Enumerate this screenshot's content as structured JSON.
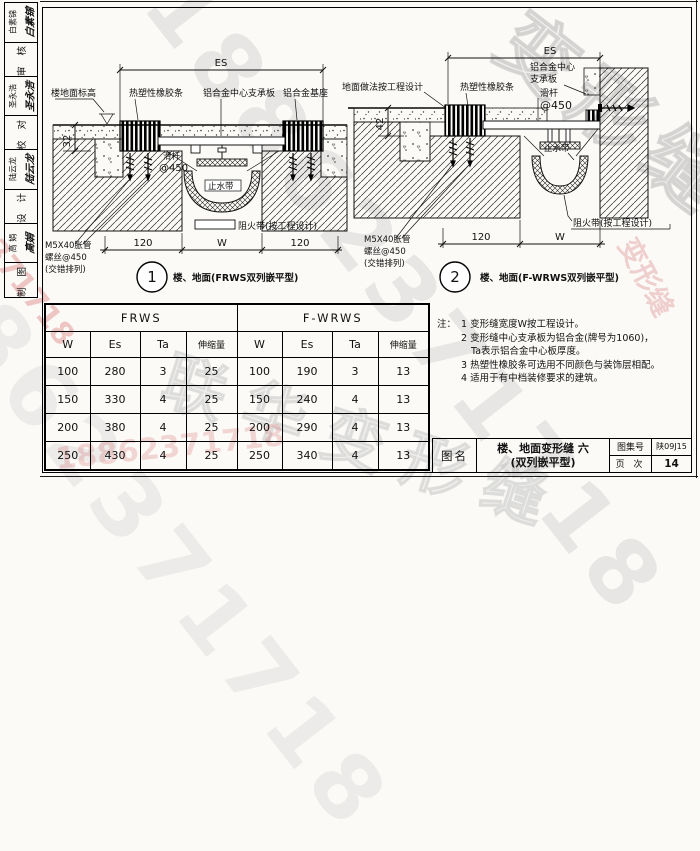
{
  "sidebar": {
    "cells": [
      {
        "name": "白素锦",
        "sig": "白素锦"
      },
      {
        "label": "审 核"
      },
      {
        "name": "圣永浩",
        "sig": "圣永浩"
      },
      {
        "label": "校 对"
      },
      {
        "name": "陆云龙",
        "sig": "陆云龙"
      },
      {
        "label": "设 计"
      },
      {
        "name": "高 娟",
        "sig": "高娟"
      },
      {
        "label": "制 图"
      }
    ]
  },
  "detail1": {
    "es": "ES",
    "dim_thickness": "32",
    "label_floor_level": "楼地面标高",
    "label_rubber": "热塑性橡胶条",
    "label_center_plate": "铝合金中心支承板",
    "label_base": "铝合金基座",
    "label_slide_rod": "滑杆",
    "label_slide_rod_spacing": "@450",
    "label_waterstop": "止水带",
    "label_fire_barrier": "阻火带(按工程设计)",
    "label_anchor_line1": "M5X40胀管",
    "label_anchor_line2": "螺丝@450",
    "label_anchor_line3": "(交错排列)",
    "dim_left": "120",
    "dim_mid": "W",
    "dim_right": "120",
    "bubble": "1",
    "caption": "楼、地面(FRWS双列嵌平型)"
  },
  "detail2": {
    "es": "ES",
    "dim_thickness": "42",
    "label_floor_finish": "地面做法按工程设计",
    "label_rubber": "热塑性橡胶条",
    "label_center_plate_1": "铝合金中心",
    "label_center_plate_2": "支承板",
    "label_slide_rod": "滑杆",
    "label_slide_rod_spacing": "@450",
    "label_waterstop": "止水带",
    "label_fire_barrier": "阻火带(按工程设计)",
    "label_anchor_line1": "M5X40胀管",
    "label_anchor_line2": "螺丝@450",
    "label_anchor_line3": "(交错排列)",
    "dim_left": "120",
    "dim_mid": "W",
    "bubble": "2",
    "caption": "楼、地面(F-WRWS双列嵌平型)"
  },
  "table": {
    "groups": [
      "FRWS",
      "F-WRWS"
    ],
    "headers": [
      "W",
      "Es",
      "Ta",
      "伸缩量",
      "W",
      "Es",
      "Ta",
      "伸缩量"
    ],
    "rows": [
      [
        "100",
        "280",
        "3",
        "25",
        "100",
        "190",
        "3",
        "13"
      ],
      [
        "150",
        "330",
        "4",
        "25",
        "150",
        "240",
        "4",
        "13"
      ],
      [
        "200",
        "380",
        "4",
        "25",
        "200",
        "290",
        "4",
        "13"
      ],
      [
        "250",
        "430",
        "4",
        "25",
        "250",
        "340",
        "4",
        "13"
      ]
    ]
  },
  "notes": {
    "prefix": "注：",
    "lines": [
      "1 变形缝宽度W按工程设计。",
      "2 变形缝中心支承板为铝合金(牌号为1060)，",
      "Ta表示铝合金中心板厚度。",
      "3 热塑性橡胶条可选用不同颜色与装饰层相配。",
      "4 适用于有中档装修要求的建筑。"
    ]
  },
  "title_block": {
    "name_label": "图名",
    "title_line1": "楼、地面变形缝 六",
    "title_line2": "(双列嵌平型)",
    "atlas_label": "图集号",
    "atlas_value": "陕09J15",
    "page_label": "页 次",
    "page_value": "14"
  },
  "watermarks": {
    "digits": "18862371718",
    "brand1": "变形缝",
    "brand2": "联华变形缝"
  }
}
